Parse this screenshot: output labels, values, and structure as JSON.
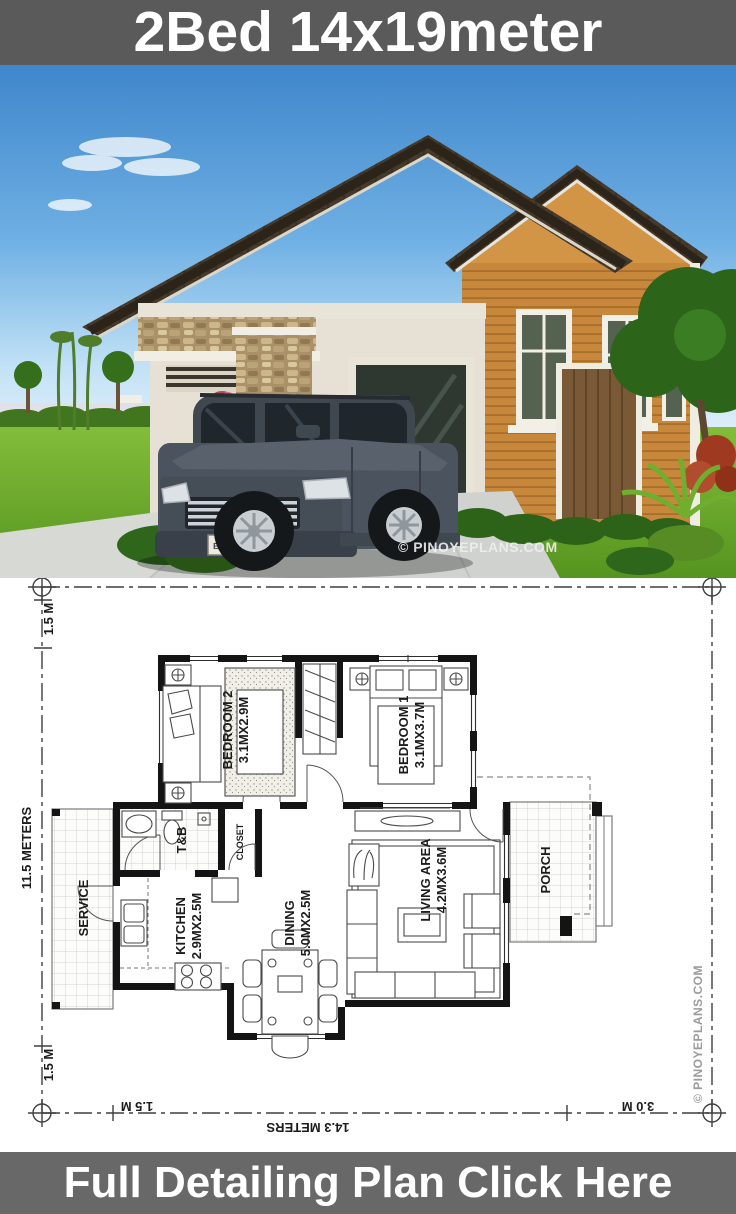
{
  "header": {
    "title": "2Bed 14x19meter",
    "bg": "#5a5a5a",
    "text_color": "#ffffff"
  },
  "footer": {
    "cta": "Full Detailing Plan Click Here",
    "bg": "#686868",
    "text_color": "#ffffff"
  },
  "photo": {
    "watermark": "© PINOYEPLANS.COM",
    "license_plate": "EVERMOTION",
    "colors": {
      "sky": "#3f86cb",
      "grass": "#6fae2d",
      "roof": "#453a2b",
      "siding": "#c8883c",
      "wall": "#e6e1d4",
      "car": "#4b545e"
    }
  },
  "plan": {
    "rooms": [
      {
        "id": "bedroom2",
        "name": "BEDROOM 2",
        "dims": "3.1MX2.9M"
      },
      {
        "id": "bedroom1",
        "name": "BEDROOM 1",
        "dims": "3.1MX3.7M"
      },
      {
        "id": "tb",
        "name": "T&B",
        "dims": ""
      },
      {
        "id": "closet",
        "name": "CLOSET",
        "dims": ""
      },
      {
        "id": "service",
        "name": "SERVICE",
        "dims": ""
      },
      {
        "id": "kitchen",
        "name": "KITCHEN",
        "dims": "2.9MX2.5M"
      },
      {
        "id": "dining",
        "name": "DINING",
        "dims": "5.0MX2.5M"
      },
      {
        "id": "living",
        "name": "LIVING AREA",
        "dims": "4.2MX3.6M"
      },
      {
        "id": "porch",
        "name": "PORCH",
        "dims": ""
      }
    ],
    "dimensions": {
      "top_left": "1.5 M",
      "left": "11.5 METERS",
      "bottom_left": "1.5 M",
      "bottom_offset": "1.5 M",
      "bottom_total": "14.3 METERS",
      "bottom_right": "3.0 M"
    },
    "watermark": "© PINOYEPLANS.COM"
  }
}
